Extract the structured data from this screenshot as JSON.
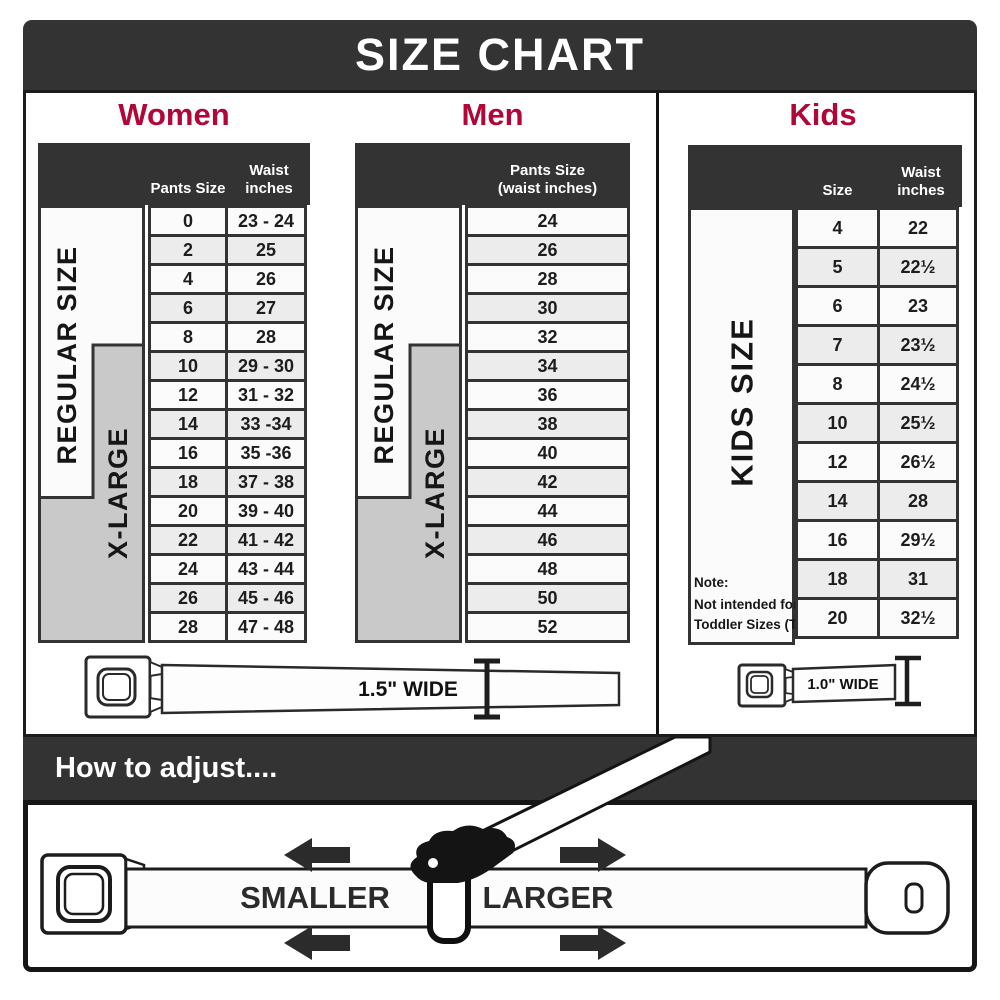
{
  "header": {
    "title": "SIZE CHART"
  },
  "sections": {
    "women": {
      "heading": "Women",
      "size_labels": {
        "regular": "REGULAR SIZE",
        "xlarge": "X-LARGE"
      },
      "columns": {
        "pants_size": "Pants Size",
        "waist_line1": "Waist",
        "waist_line2": "inches"
      },
      "rows": [
        {
          "size": "0",
          "waist": "23 - 24"
        },
        {
          "size": "2",
          "waist": "25"
        },
        {
          "size": "4",
          "waist": "26"
        },
        {
          "size": "6",
          "waist": "27"
        },
        {
          "size": "8",
          "waist": "28"
        },
        {
          "size": "10",
          "waist": "29 - 30"
        },
        {
          "size": "12",
          "waist": "31 - 32"
        },
        {
          "size": "14",
          "waist": "33 -34"
        },
        {
          "size": "16",
          "waist": "35 -36"
        },
        {
          "size": "18",
          "waist": "37 - 38"
        },
        {
          "size": "20",
          "waist": "39 - 40"
        },
        {
          "size": "22",
          "waist": "41 - 42"
        },
        {
          "size": "24",
          "waist": "43 - 44"
        },
        {
          "size": "26",
          "waist": "45 - 46"
        },
        {
          "size": "28",
          "waist": "47 - 48"
        }
      ]
    },
    "men": {
      "heading": "Men",
      "size_labels": {
        "regular": "REGULAR SIZE",
        "xlarge": "X-LARGE"
      },
      "columns": {
        "line1": "Pants Size",
        "line2": "(waist inches)"
      },
      "rows": [
        "24",
        "26",
        "28",
        "30",
        "32",
        "34",
        "36",
        "38",
        "40",
        "42",
        "44",
        "46",
        "48",
        "50",
        "52"
      ]
    },
    "kids": {
      "heading": "Kids",
      "size_label": "KIDS SIZE",
      "columns": {
        "size": "Size",
        "waist_line1": "Waist",
        "waist_line2": "inches"
      },
      "rows": [
        {
          "size": "4",
          "waist": "22"
        },
        {
          "size": "5",
          "waist": "22½"
        },
        {
          "size": "6",
          "waist": "23"
        },
        {
          "size": "7",
          "waist": "23½"
        },
        {
          "size": "8",
          "waist": "24½"
        },
        {
          "size": "10",
          "waist": "25½"
        },
        {
          "size": "12",
          "waist": "26½"
        },
        {
          "size": "14",
          "waist": "28"
        },
        {
          "size": "16",
          "waist": "29½"
        },
        {
          "size": "18",
          "waist": "31"
        },
        {
          "size": "20",
          "waist": "32½"
        }
      ],
      "note": {
        "line1": "Note:",
        "line2": "Not intended for",
        "line3": "Toddler Sizes (T)"
      }
    }
  },
  "belts": {
    "adult_width_label": "1.5\" WIDE",
    "kids_width_label": "1.0\" WIDE"
  },
  "adjust": {
    "heading": "How to adjust....",
    "smaller_label": "SMALLER",
    "larger_label": "LARGER"
  },
  "colors": {
    "banner_dark": "#333333",
    "accent_red": "#b00638",
    "row_light": "#fbfbfb",
    "row_shaded": "#ececec",
    "xlarge_gray": "#c9c9c9"
  }
}
